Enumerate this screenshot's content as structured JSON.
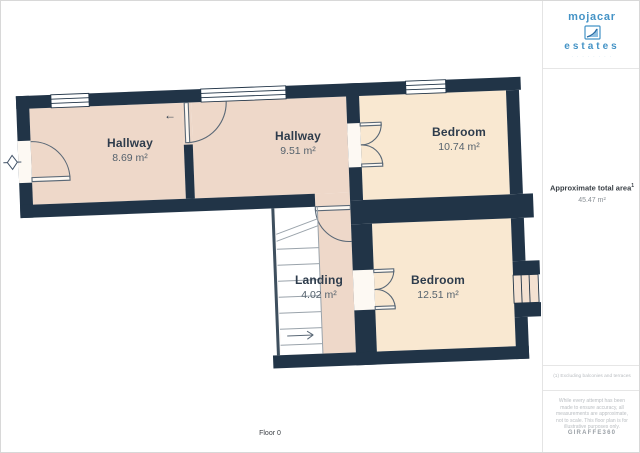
{
  "plan": {
    "rooms": [
      {
        "id": "hallway-1",
        "name": "Hallway",
        "area": "8.69 m²"
      },
      {
        "id": "hallway-2",
        "name": "Hallway",
        "area": "9.51 m²"
      },
      {
        "id": "bedroom-1",
        "name": "Bedroom",
        "area": "10.74 m²"
      },
      {
        "id": "landing",
        "name": "Landing",
        "area": "4.02 m²"
      },
      {
        "id": "bedroom-2",
        "name": "Bedroom",
        "area": "12.51 m²"
      }
    ],
    "floor_label": "Floor 0",
    "icons": {
      "direction_arrow": "←",
      "entrance_marker": "diamond-with-ticks",
      "watermark": "triangle-marker"
    },
    "colors": {
      "wall": "#213447",
      "hallway_fill": "#eed8c9",
      "bedroom_fill": "#f9e8d1",
      "door_line": "#5a6876",
      "stairs_line": "#9aa3ab"
    }
  },
  "sidebar": {
    "logo": {
      "line1": "mojacar",
      "line2": "estates",
      "tagline": "· · · · · · · ·",
      "color": "#4493c6"
    },
    "total_area": {
      "label": "Approximate total area",
      "sup": "1",
      "value": "45.47 m²"
    },
    "footnote": "(1) Excluding balconies and terraces",
    "disclaimer": "While every attempt has been made to ensure accuracy, all measurements are approximate, not to scale. This floor plan is for illustrative purposes only.",
    "brand": "GIRAFFE360"
  }
}
